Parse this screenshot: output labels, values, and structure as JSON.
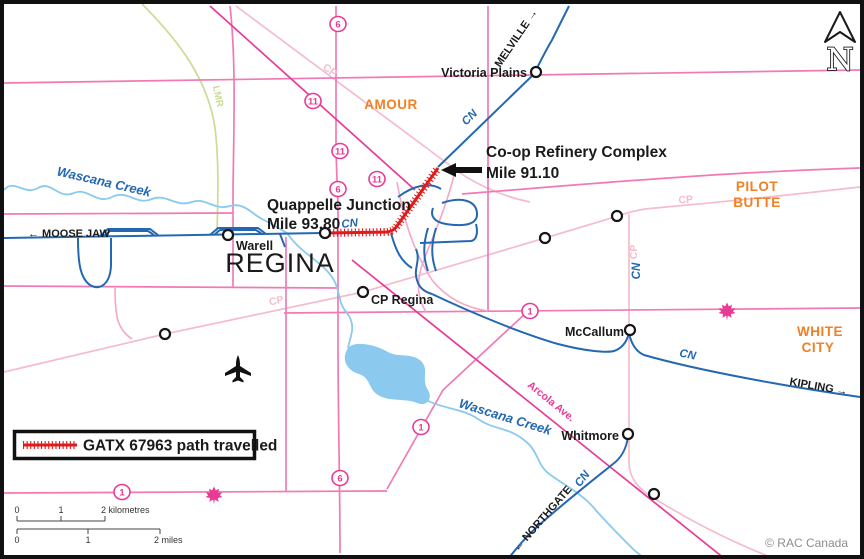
{
  "colors": {
    "road_pink": "#f17ab5",
    "road_light_pink": "#f5a6c9",
    "magenta": "#e93a96",
    "cp_pink": "#f5bccb",
    "cn_blue": "#2468b2",
    "creek_blue": "#8bc9ee",
    "green": "#cbdc96",
    "orange": "#ef8023",
    "path_red": "#e01b1c",
    "ink": "#1a1a1a",
    "credit_gray": "#8e8e8e"
  },
  "city": {
    "regina": "REGINA"
  },
  "regions": {
    "amour": "AMOUR",
    "pilot": "PILOT",
    "butte": "BUTTE",
    "white": "WHITE",
    "city": "CITY"
  },
  "stations": {
    "victoria_plains": "Victoria Plains",
    "warell": "Warell",
    "cp_regina": "CP Regina",
    "mccallum": "McCallum",
    "whitmore": "Whitmore"
  },
  "annotations": {
    "refinery_1": "Co-op Refinery Complex",
    "refinery_2": "Mile 91.10",
    "junction_1": "Quappelle Junction",
    "junction_2": "Mile 93.80"
  },
  "directions": {
    "moose_jaw": "← MOOSE JAW",
    "melville": "MELVILLE →",
    "kipling": "KIPLING →",
    "northgate": "← NORTHGATE"
  },
  "rail_labels": {
    "cn": "CN",
    "cp": "CP",
    "lmr": "LMR"
  },
  "street_labels": {
    "arcola": "Arcola Ave."
  },
  "water_labels": {
    "wascana": "Wascana Creek"
  },
  "shields": {
    "h1": "1",
    "h6": "6",
    "h11": "11"
  },
  "legend": {
    "label": "GATX 67963 path travelled"
  },
  "scalebar": {
    "km0": "0",
    "km1": "1",
    "km2": "2 kilometres",
    "mi0": "0",
    "mi1": "1",
    "mi2": "2 miles"
  },
  "compass": {
    "letter": "N"
  },
  "credit": "© RAC Canada"
}
